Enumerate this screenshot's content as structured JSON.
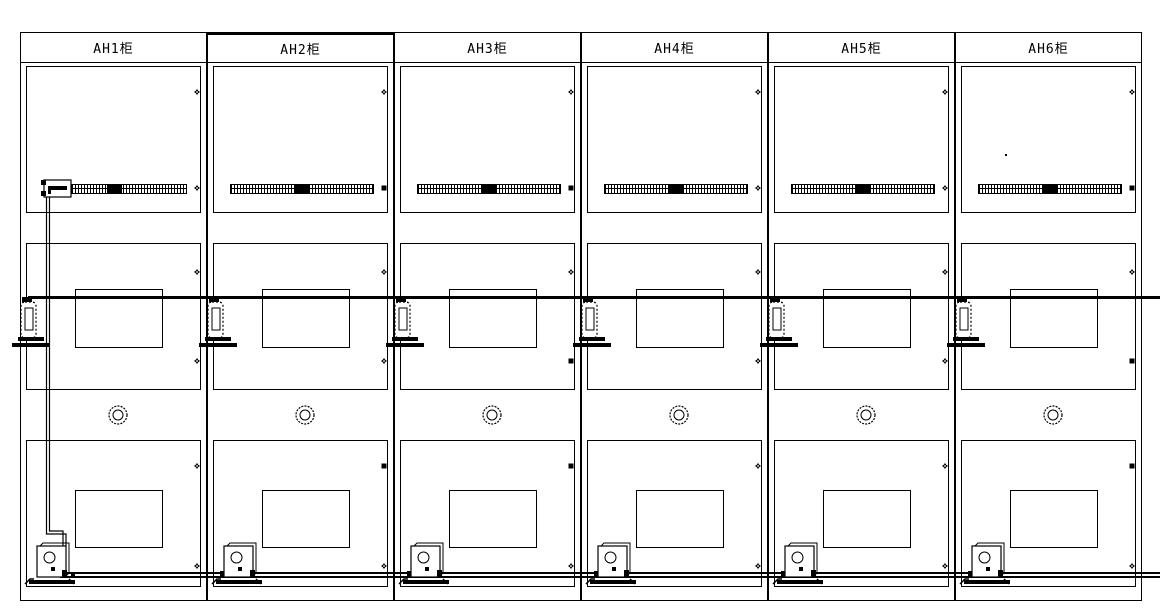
{
  "drawing": {
    "type": "cad-front-elevation",
    "background_color": "#ffffff",
    "line_color": "#000000",
    "cabinets": [
      {
        "id": "AH1",
        "label": "AH1柜",
        "title_top_border": "thin",
        "has_incoming_connector": true,
        "has_wire_drop": true,
        "has_dot": false,
        "top_row_markers": [
          "flower",
          "flower"
        ],
        "middle_row_markers": [
          "flower",
          "flower"
        ],
        "bottom_row_markers": [
          "flower",
          "flower"
        ]
      },
      {
        "id": "AH2",
        "label": "AH2柜",
        "title_top_border": "thick",
        "has_incoming_connector": false,
        "has_wire_drop": false,
        "has_dot": false,
        "top_row_markers": [
          "flower",
          "square"
        ],
        "middle_row_markers": [
          "flower",
          "flower"
        ],
        "bottom_row_markers": [
          "square",
          "flower"
        ]
      },
      {
        "id": "AH3",
        "label": "AH3柜",
        "title_top_border": "thin",
        "has_incoming_connector": false,
        "has_wire_drop": false,
        "has_dot": false,
        "top_row_markers": [
          "flower",
          "square"
        ],
        "middle_row_markers": [
          "flower",
          "square"
        ],
        "bottom_row_markers": [
          "square",
          "flower"
        ]
      },
      {
        "id": "AH4",
        "label": "AH4柜",
        "title_top_border": "thin",
        "has_incoming_connector": false,
        "has_wire_drop": false,
        "has_dot": false,
        "top_row_markers": [
          "flower",
          "flower"
        ],
        "middle_row_markers": [
          "flower",
          "flower"
        ],
        "bottom_row_markers": [
          "flower",
          "flower"
        ]
      },
      {
        "id": "AH5",
        "label": "AH5柜",
        "title_top_border": "thin",
        "has_incoming_connector": false,
        "has_wire_drop": false,
        "has_dot": false,
        "top_row_markers": [
          "flower",
          "flower"
        ],
        "middle_row_markers": [
          "flower",
          "flower"
        ],
        "bottom_row_markers": [
          "flower",
          "flower"
        ]
      },
      {
        "id": "AH6",
        "label": "AH6柜",
        "title_top_border": "thin",
        "has_incoming_connector": false,
        "has_wire_drop": false,
        "has_dot": true,
        "top_row_markers": [
          "flower",
          "square"
        ],
        "middle_row_markers": [
          "flower",
          "square"
        ],
        "bottom_row_markers": [
          "square",
          "flower"
        ]
      }
    ],
    "shared_symbols": {
      "vent_grille": "hatched-terminal-strip-with-black-segment",
      "door_knob": "concentric-double-circle",
      "door_window": "rectangle",
      "side_latch": "dashed-capsule-latch-on-base",
      "floor_device": "actuator-box-with-circle-on-base-plate",
      "mid_bus_line": "thick-horizontal-line",
      "bottom_bus_line": "double-horizontal-line"
    }
  }
}
